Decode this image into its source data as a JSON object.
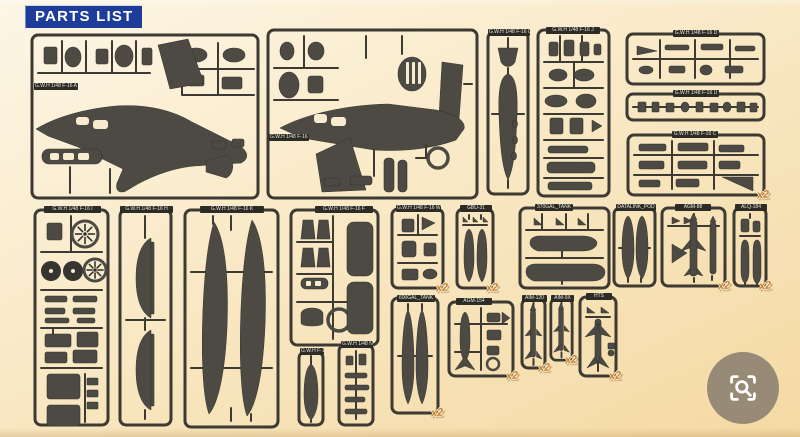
{
  "header": {
    "title": "PARTS LIST"
  },
  "badges": {
    "x2": "x2"
  },
  "zoom_button": {
    "icon": "scan-search-icon"
  },
  "colors": {
    "bg_top": "#fdf6e6",
    "bg_mid": "#f9e9c6",
    "bg_bottom": "#f4d9a3",
    "frame": "#3c3a33",
    "part": "#4c4a43",
    "part_dark": "#35342e",
    "cream": "#f7ecd0",
    "label_bg": "#2c2b26",
    "label_text": "#e8e4da",
    "header_bg": "#1d3d99",
    "header_text": "#ffffff",
    "x2": "#c9802f"
  },
  "sprues": [
    {
      "id": "A",
      "label": "G.W.H 1/48 F-16 A",
      "type": "fuselage_top",
      "x": 30,
      "y": 33,
      "w": 230,
      "h": 167,
      "x2": false,
      "lx": 4,
      "ly": 50,
      "lw": 42
    },
    {
      "id": "B",
      "label": "G.W.H 1/48 F-16 B",
      "type": "fuselage_side",
      "x": 266,
      "y": 28,
      "w": 213,
      "h": 172,
      "x2": false,
      "lx": 3,
      "ly": 106,
      "lw": 38
    },
    {
      "id": "Q",
      "label": "G.W.H 1/48 F-16 Q",
      "type": "pod_tall",
      "x": 486,
      "y": 30,
      "w": 44,
      "h": 166,
      "x2": false,
      "lx": 2,
      "ly": -1,
      "lw": 40
    },
    {
      "id": "J",
      "label": "G.W.H 1/48 F-16 J",
      "type": "grid_tall",
      "x": 536,
      "y": 28,
      "w": 75,
      "h": 170,
      "x2": false,
      "lx": 10,
      "ly": -1,
      "lw": 52
    },
    {
      "id": "D",
      "label": "G.W.H 1/48 F-16 D",
      "type": "grid_wide",
      "x": 625,
      "y": 32,
      "w": 141,
      "h": 54,
      "x2": false,
      "lx": 48,
      "ly": -2,
      "lw": 44
    },
    {
      "id": "U",
      "label": "G.W.H 1/48 F-16 U",
      "type": "grid_strip",
      "x": 625,
      "y": 92,
      "w": 141,
      "h": 30,
      "x2": false,
      "lx": 48,
      "ly": -2,
      "lw": 44
    },
    {
      "id": "C",
      "label": "G.W.H 1/48 F-16 C",
      "type": "grid_wide2",
      "x": 626,
      "y": 133,
      "w": 140,
      "h": 64,
      "x2": true,
      "lx": 46,
      "ly": -2,
      "lw": 44
    },
    {
      "id": "I",
      "label": "G.W.H 1/48 F-16 I",
      "type": "wheels",
      "x": 33,
      "y": 208,
      "w": 77,
      "h": 219,
      "x2": false,
      "lx": 11,
      "ly": -2,
      "lw": 55
    },
    {
      "id": "H",
      "label": "G.W.H 1/48 F-16 H",
      "type": "tank_halves",
      "x": 118,
      "y": 208,
      "w": 55,
      "h": 219,
      "x2": false,
      "lx": 2,
      "ly": -2,
      "lw": 51
    },
    {
      "id": "K",
      "label": "G.W.H 1/48 F-16 K",
      "type": "cft",
      "x": 183,
      "y": 208,
      "w": 97,
      "h": 221,
      "x2": false,
      "lx": 17,
      "ly": -2,
      "lw": 62
    },
    {
      "id": "F",
      "label": "G.W.H 1/48 F-16 F",
      "type": "nozzles",
      "x": 289,
      "y": 208,
      "w": 91,
      "h": 139,
      "x2": false,
      "lx": 26,
      "ly": -2,
      "lw": 56
    },
    {
      "id": "G",
      "label": "G.W.H F-16 G",
      "type": "pod_small",
      "x": 297,
      "y": 350,
      "w": 28,
      "h": 77,
      "x2": false,
      "lx": 3,
      "ly": -2,
      "lw": 22
    },
    {
      "id": "N",
      "label": "G.W.H 1/48 N",
      "type": "grid_small",
      "x": 337,
      "y": 343,
      "w": 38,
      "h": 84,
      "x2": false,
      "lx": 4,
      "ly": -2,
      "lw": 30
    },
    {
      "id": "W",
      "label": "G.W.H 1/48 F-16 W",
      "type": "grid_small2",
      "x": 390,
      "y": 207,
      "w": 55,
      "h": 83,
      "x2": true,
      "lx": 6,
      "ly": -2,
      "lw": 43
    },
    {
      "id": "GBU-31",
      "label": "GBU-31",
      "type": "bombs",
      "x": 455,
      "y": 207,
      "w": 40,
      "h": 83,
      "x2": true,
      "lx": 5,
      "ly": -2,
      "lw": 30
    },
    {
      "id": "600GAL",
      "label": "600GAL_TANK",
      "type": "tank_halves_slim",
      "x": 390,
      "y": 296,
      "w": 50,
      "h": 119,
      "x2": true,
      "lx": 7,
      "ly": -1,
      "lw": 36
    },
    {
      "id": "AGM-154",
      "label": "AGM-154",
      "type": "pod_missile",
      "x": 447,
      "y": 300,
      "w": 68,
      "h": 78,
      "x2": true,
      "lx": 9,
      "ly": -2,
      "lw": 34
    },
    {
      "id": "370GAL",
      "label": "370GAL_TANK",
      "type": "tanks_h",
      "x": 518,
      "y": 206,
      "w": 93,
      "h": 84,
      "x2": false,
      "lx": 17,
      "ly": -2,
      "lw": 36
    },
    {
      "id": "DATALINK",
      "label": "DATALINK_POD",
      "type": "pods_pair",
      "x": 612,
      "y": 206,
      "w": 45,
      "h": 82,
      "x2": false,
      "lx": 4,
      "ly": -2,
      "lw": 38
    },
    {
      "id": "AGM-88",
      "label": "AGM-88",
      "type": "harm",
      "x": 660,
      "y": 206,
      "w": 67,
      "h": 82,
      "x2": true,
      "lx": 15,
      "ly": -2,
      "lw": 34
    },
    {
      "id": "ALQ-184",
      "label": "ALQ-184",
      "type": "pod_halves",
      "x": 732,
      "y": 206,
      "w": 36,
      "h": 82,
      "x2": true,
      "lx": 3,
      "ly": -2,
      "lw": 30
    },
    {
      "id": "AIM-120",
      "label": "AIM-120",
      "type": "missile",
      "x": 520,
      "y": 297,
      "w": 27,
      "h": 73,
      "x2": true,
      "lx": 2,
      "ly": -2,
      "lw": 23
    },
    {
      "id": "AIM-9X",
      "label": "AIM-9X",
      "type": "missile",
      "x": 549,
      "y": 297,
      "w": 25,
      "h": 65,
      "x2": true,
      "lx": 2,
      "ly": -2,
      "lw": 21
    },
    {
      "id": "HTS",
      "label": "HTS",
      "type": "hts",
      "x": 578,
      "y": 295,
      "w": 40,
      "h": 83,
      "x2": true,
      "lx": 8,
      "ly": -2,
      "lw": 24
    }
  ]
}
